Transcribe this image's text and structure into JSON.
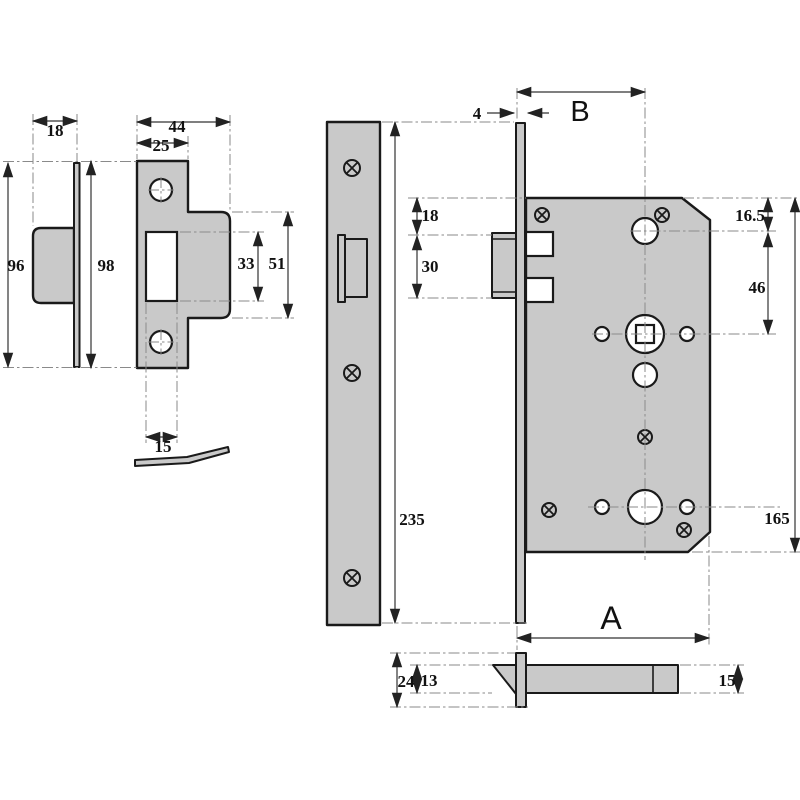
{
  "colors": {
    "background": "#ffffff",
    "metal_fill": "#c9c9c9",
    "outline": "#1a1a1a",
    "dimension_line": "#333333",
    "centerline": "#8a8a8a",
    "text": "#111111"
  },
  "dims": {
    "side_thickness": "18",
    "side_height": "96",
    "front_overall_width": "44",
    "front_plate_width": "25",
    "front_height": "98",
    "front_cutout_height": "33",
    "front_lip_height": "51",
    "front_cutout_width": "15",
    "faceplate_length": "235",
    "faceplate_projection": "4",
    "backset_label": "B",
    "latch_top_offset": "18",
    "latch_height": "30",
    "cylinder_top_offset": "16.5",
    "cylinder_to_spindle": "46",
    "case_height": "165",
    "case_depth_label": "A",
    "latch_overall_height": "24",
    "latch_bolt_height": "13",
    "latch_bolt_length": "15"
  }
}
